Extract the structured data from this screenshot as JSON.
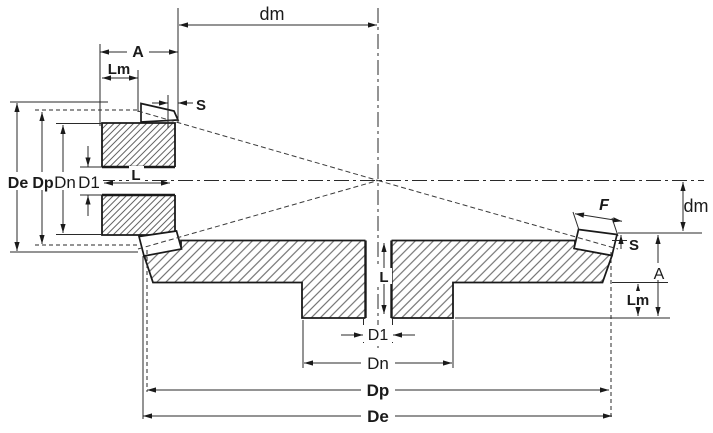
{
  "labels": {
    "dm_top": "dm",
    "a_top": "A",
    "lm_top": "Lm",
    "s_top": "S",
    "de_left": "De",
    "dp_left": "Dp",
    "dn_left": "Dn",
    "d1_left": "D1",
    "l_pinion": "L",
    "f": "F",
    "s_right": "S",
    "dm_right": "dm",
    "a_right": "A",
    "lm_right": "Lm",
    "l_gear": "L",
    "d1_bottom": "D1",
    "dn_bottom": "Dn",
    "dp_bottom": "Dp",
    "de_bottom": "De"
  },
  "colors": {
    "background": "#ffffff",
    "line": "#1a1a1a",
    "hatch": "#5a5a5a"
  }
}
